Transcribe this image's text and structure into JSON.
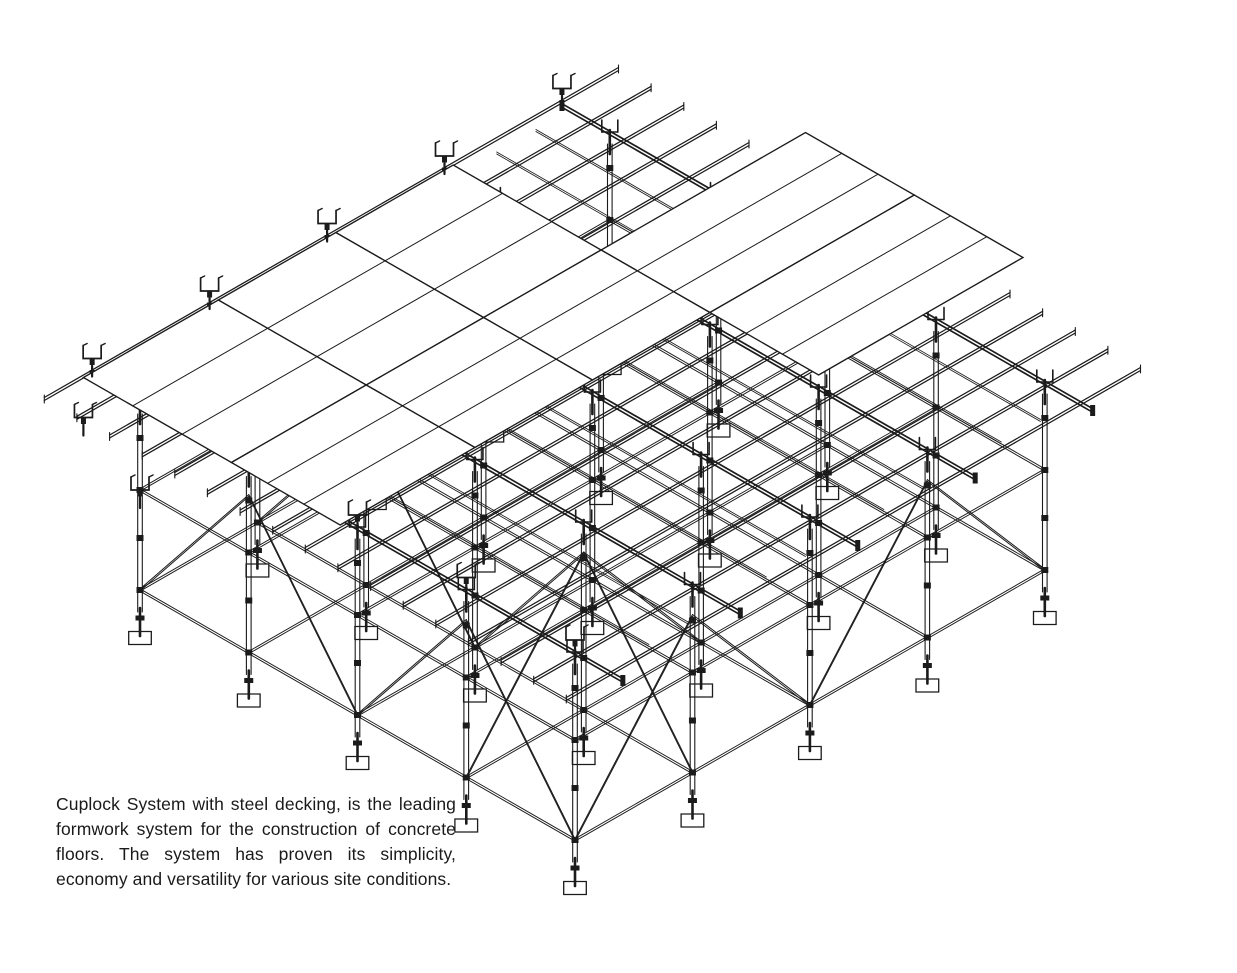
{
  "page": {
    "background": "#ffffff"
  },
  "figure": {
    "name": "cuplock-steel-decking-isometric-drawing",
    "subject": "Cuplock scaffolding formwork system supporting steel decking panels",
    "ink_color": "#1b1b1b",
    "panel_fill": "#ffffff"
  },
  "caption": {
    "text": "Cuplock System with steel decking, is the leading formwork system for the construction of concrete floors. The system has proven its simplicity, economy and versatility for various site conditions."
  }
}
